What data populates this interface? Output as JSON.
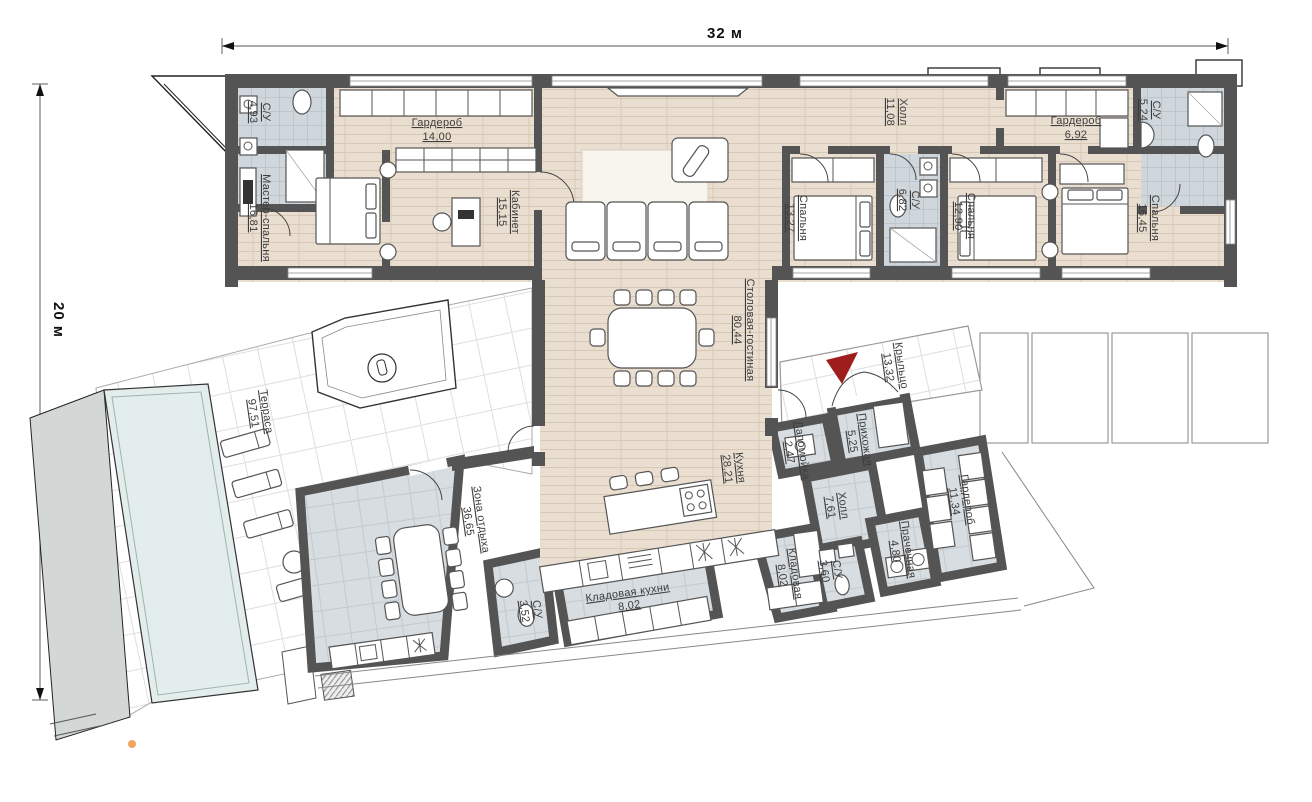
{
  "dimensions": {
    "width": "32 м",
    "height": "20 м"
  },
  "colors": {
    "wall": "#545454",
    "wood_floor": "#e9ded0",
    "tile_floor": "#d7dde1",
    "bath_floor": "#d0d7dc",
    "pool": "#e3edec",
    "entrance_arrow": "#9e1d1d",
    "marker_dot": "#f2a45f"
  },
  "rooms": [
    {
      "name": "С/У",
      "area": "4,93"
    },
    {
      "name": "Гардероб",
      "area": "14,00"
    },
    {
      "name": "Мастер-спальня",
      "area": "16,81"
    },
    {
      "name": "Кабинет",
      "area": "15,15"
    },
    {
      "name": "Столовая-гостиная",
      "area": "80,44"
    },
    {
      "name": "Кухня",
      "area": "28,21"
    },
    {
      "name": "Холл",
      "area": "11,08"
    },
    {
      "name": "Спальня",
      "area": "13,27"
    },
    {
      "name": "С/У",
      "area": "6,82"
    },
    {
      "name": "Спальня",
      "area": "12,90"
    },
    {
      "name": "Гардероб",
      "area": "6,92"
    },
    {
      "name": "С/У",
      "area": "5,24"
    },
    {
      "name": "Спальня",
      "area": "16,45"
    },
    {
      "name": "Терраса",
      "area": "97,51"
    },
    {
      "name": "Зона отдыха",
      "area": "36,65"
    },
    {
      "name": "С/У",
      "area": "3,52"
    },
    {
      "name": "Кладовая кухни",
      "area": "8,02"
    },
    {
      "name": "Кладовая",
      "area": "8,02"
    },
    {
      "name": "Холл",
      "area": "7,61"
    },
    {
      "name": "Прихожая",
      "area": "5,25"
    },
    {
      "name": "Лапомойка",
      "area": "2,47"
    },
    {
      "name": "Гардероб",
      "area": "11,34"
    },
    {
      "name": "Прачечная",
      "area": "4,80"
    },
    {
      "name": "С/У",
      "area": "3,60"
    },
    {
      "name": "Крыльцо",
      "area": "13,32"
    }
  ]
}
